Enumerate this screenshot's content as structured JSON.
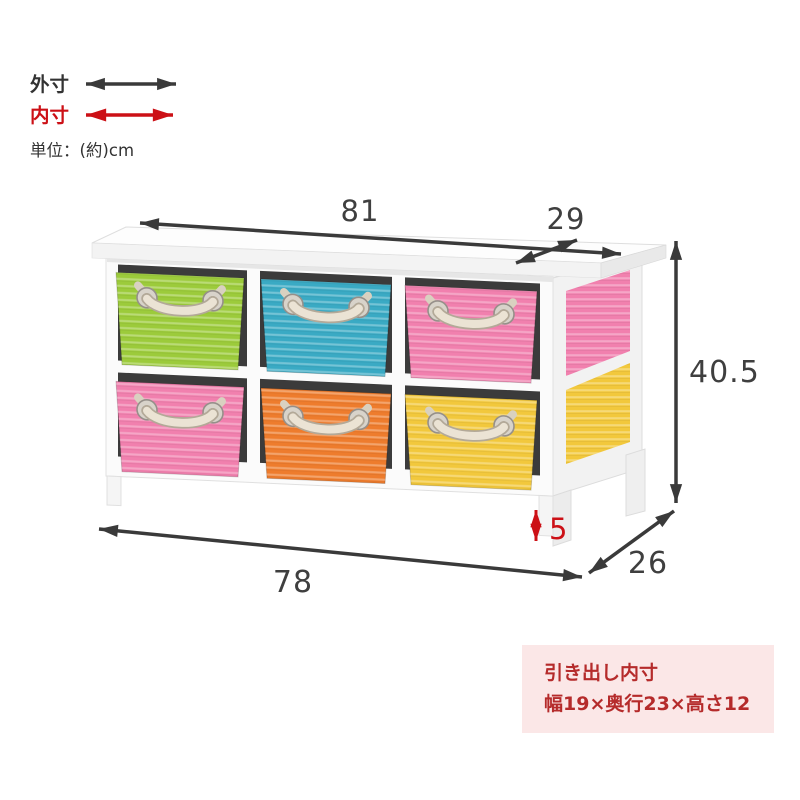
{
  "legend": {
    "outer_label": "外寸",
    "inner_label": "内寸",
    "unit_label": "単位：(約)cm"
  },
  "dimensions": {
    "top_width": "81",
    "top_depth": "29",
    "height": "40.5",
    "bottom_width": "78",
    "bottom_depth": "26",
    "leg_height": "5"
  },
  "info_box": {
    "title": "引き出し内寸",
    "size_text": "幅19×奥行23×高さ12"
  },
  "furniture": {
    "description": "White 2x3 storage chest with colorful woven basket drawers and rope handles",
    "basket_colors_top_row": [
      "green",
      "blue",
      "pink"
    ],
    "basket_colors_bottom_row": [
      "pink",
      "orange",
      "yellow"
    ]
  },
  "colors": {
    "outer_dim": "#3a3a3a",
    "inner_dim": "#cc1016",
    "dim_text": "#3f3f3f",
    "info_box_bg": "#fbe7e7",
    "info_box_text": "#b52b2b",
    "basket_green": "#9ccb3b",
    "basket_blue": "#3aaac4",
    "basket_pink": "#f180ae",
    "basket_orange": "#ee7c2d",
    "basket_yellow": "#f2c83c",
    "frame_white": "#fbfbfb"
  }
}
